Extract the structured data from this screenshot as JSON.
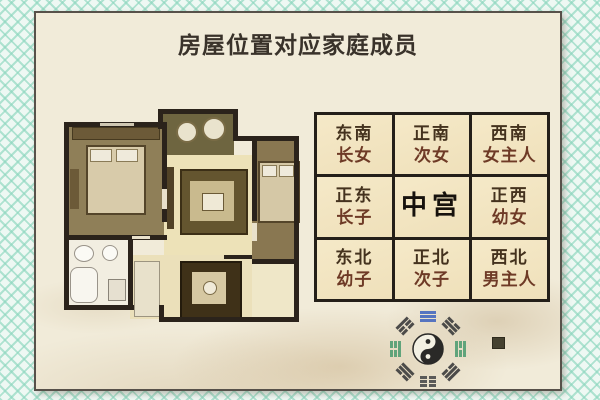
{
  "title": "房屋位置对应家庭成员",
  "palace_grid": {
    "cells": [
      {
        "direction": "东南",
        "member": "长女"
      },
      {
        "direction": "正南",
        "member": "次女"
      },
      {
        "direction": "西南",
        "member": "女主人"
      },
      {
        "direction": "正东",
        "member": "长子"
      },
      {
        "direction": "中宫",
        "member": ""
      },
      {
        "direction": "正西",
        "member": "幼女"
      },
      {
        "direction": "东北",
        "member": "幼子"
      },
      {
        "direction": "正北",
        "member": "次子"
      },
      {
        "direction": "西北",
        "member": "男主人"
      }
    ]
  },
  "icons": {
    "bagua": "taiji-bagua-emblem",
    "seal": "dark-seal-stamp"
  },
  "colors": {
    "frame_mint": "#8cd6be",
    "card_bg": "#f1ebd9",
    "cell_bg": "#f3e6c2",
    "grid_line": "#241f19",
    "wall": "#2b231b",
    "direction_text": "#44321e",
    "member_text": "#6e3a26"
  }
}
